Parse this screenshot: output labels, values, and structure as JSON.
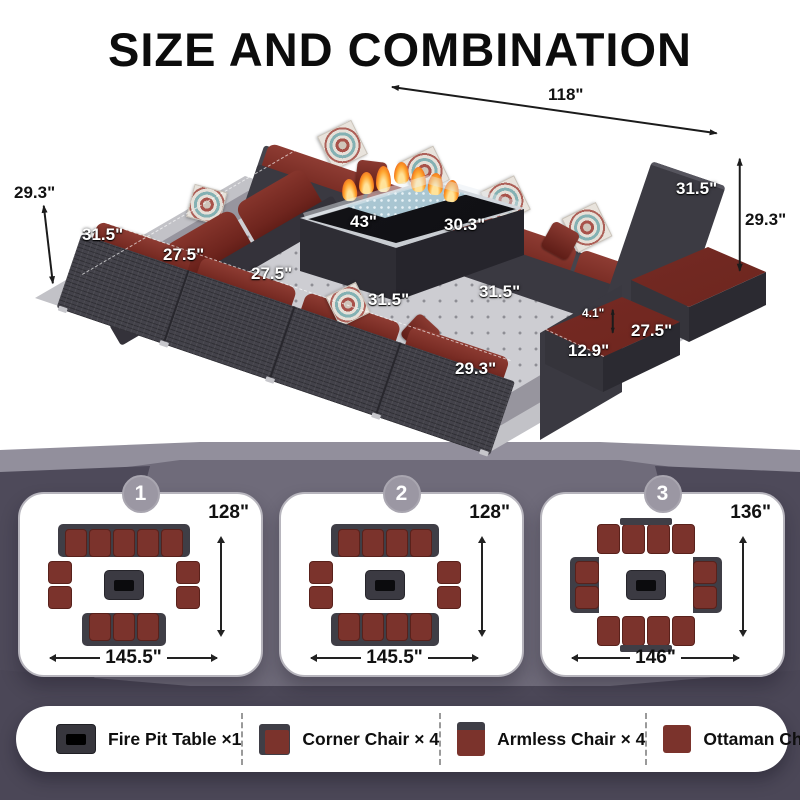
{
  "title": "SIZE AND COMBINATION",
  "photo": {
    "dims": {
      "w118": "118\"",
      "h293_left": "29.3\"",
      "w315_left": "31.5\"",
      "w275_a": "27.5\"",
      "w275_b": "27.5\"",
      "w315_front": "31.5\"",
      "w315_corner": "31.5\"",
      "h293_front": "29.3\"",
      "w43": "43\"",
      "w303": "30.3\"",
      "w315_arm": "31.5\"",
      "h293_right": "29.3\"",
      "h41": "4.1\"",
      "w275_ottoman": "27.5\"",
      "h129": "12.9\""
    }
  },
  "layouts": [
    {
      "badge": "1",
      "height_label": "128\"",
      "width_label": "145.5\"",
      "top": 5,
      "bottom": 3,
      "left": 2,
      "right": 2,
      "style": "panel"
    },
    {
      "badge": "2",
      "height_label": "128\"",
      "width_label": "145.5\"",
      "top": 4,
      "bottom": 4,
      "left": 2,
      "right": 2,
      "style": "panel"
    },
    {
      "badge": "3",
      "height_label": "136\"",
      "width_label": "146\"",
      "top": 4,
      "bottom": 4,
      "left": 2,
      "right": 2,
      "style": "tabs"
    }
  ],
  "legend": {
    "items": [
      {
        "icon": "fire-pit-table-icon",
        "label": "Fire Pit Table ×1"
      },
      {
        "icon": "corner-chair-icon",
        "label": "Corner Chair × 4"
      },
      {
        "icon": "armless-chair-icon",
        "label": "Armless Chair × 4"
      },
      {
        "icon": "ottaman-chair-icon",
        "label": "Ottaman Chair × 4"
      }
    ]
  },
  "colors": {
    "cushion_red": "#7b332c",
    "wicker_dark": "#3f3e46",
    "bg_mid": "#6f6b7a"
  }
}
